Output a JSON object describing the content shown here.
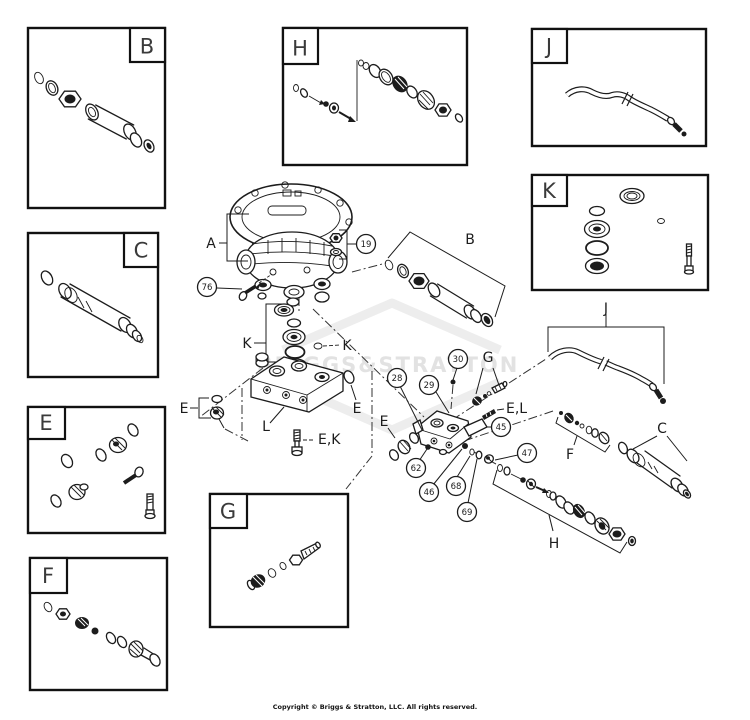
{
  "page": {
    "background_color": "#ffffff",
    "line_color": "#1c1c1c",
    "watermark_color": "#e2e2e2",
    "watermark_text": "BRIGGS&STRATTON",
    "copyright_text": "Copyright © Briggs & Stratton, LLC. All rights reserved."
  },
  "detail_box_labels": {
    "b": "B",
    "c": "C",
    "e": "E",
    "f": "F",
    "h": "H",
    "j": "J",
    "k": "K",
    "g": "G"
  },
  "callouts": {
    "n19": "19",
    "n76": "76",
    "n28": "28",
    "n29": "29",
    "n30": "30",
    "n45": "45",
    "n46": "46",
    "n47": "47",
    "n62": "62",
    "n68": "68",
    "n69": "69"
  },
  "assembly_labels": {
    "a": "A",
    "b_group": "B",
    "k_stack": "K",
    "k_oring": "K",
    "l_manifold": "L",
    "e_left": "E",
    "e_oring": "E",
    "e_spring": "E",
    "ek_bolt": "E,K",
    "el_stud": "E,L",
    "g_chain": "G",
    "j_hose": "J",
    "f_chain": "F",
    "c_tube": "C",
    "h_chain": "H"
  }
}
